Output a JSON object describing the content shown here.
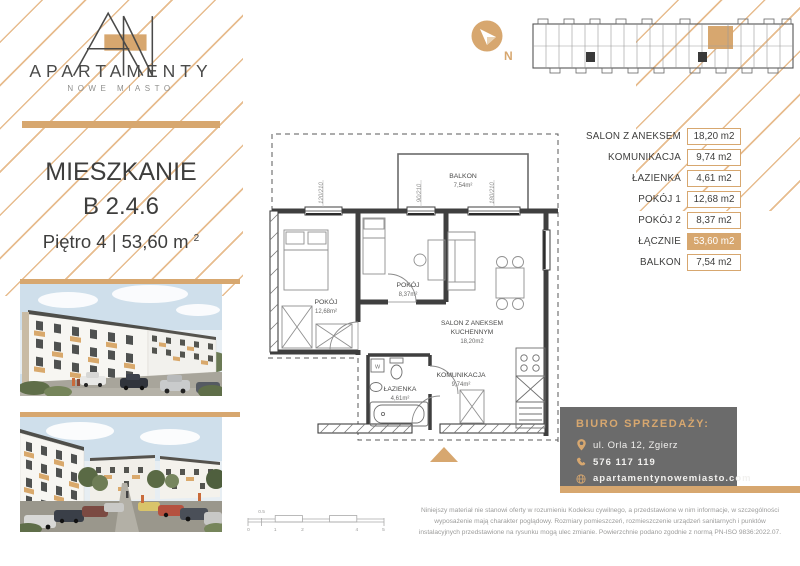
{
  "brand": {
    "name": "APARTAMENTY",
    "subtitle": "NOWE MIASTO",
    "monogram": "AN"
  },
  "compass": {
    "label": "N"
  },
  "listing": {
    "type_label": "MIESZKANIE",
    "unit": "B 2.4.6",
    "floor_line": "Piętro 4 | 53,60 m",
    "area_sup": "2"
  },
  "area_table": {
    "rows": [
      {
        "label": "SALON Z ANEKSEM",
        "value": "18,20 m2"
      },
      {
        "label": "KOMUNIKACJA",
        "value": "9,74 m2"
      },
      {
        "label": "ŁAZIENKA",
        "value": "4,61 m2"
      },
      {
        "label": "POKÓJ 1",
        "value": "12,68 m2"
      },
      {
        "label": "POKÓJ 2",
        "value": "8,37 m2"
      },
      {
        "label": "ŁĄCZNIE",
        "value": "53,60 m2",
        "highlight": true
      },
      {
        "label": "BALKON",
        "value": "7,54 m2"
      }
    ]
  },
  "floor_plan": {
    "balkon": {
      "name": "BALKON",
      "area": "7,54m²"
    },
    "pokoj1": {
      "name": "POKÓJ",
      "area": "12,68m²"
    },
    "pokoj2": {
      "name": "POKÓJ",
      "area": "8,37m²"
    },
    "salon": {
      "line1": "SALON Z ANEKSEM",
      "line2": "KUCHENNYM",
      "area": "18,20m2"
    },
    "komunikacja": {
      "name": "KOMUNIKACJA",
      "area": "9,74m²"
    },
    "lazienka": {
      "name": "ŁAZIENKA",
      "area": "4,61m²"
    },
    "washer_label": "W",
    "window_dims": [
      "120/210",
      "90/210",
      "180/210"
    ]
  },
  "sales_office": {
    "title": "BIURO SPRZEDAŻY:",
    "address": "ul. Orla 12, Zgierz",
    "phone": "576 117 119",
    "website": "apartamentynowemiasto.com"
  },
  "scale_bar": {
    "labels": [
      "0",
      "0.5",
      "1",
      "2",
      "4",
      "5"
    ]
  },
  "disclaimer": {
    "line1": "Niniejszy materiał nie stanowi oferty w rozumieniu Kodeksu cywilnego, a przedstawione w nim informacje, w szczególności",
    "line2": "wyposażenie mają charakter poglądowy. Rozmiary pomieszczeń, rozmieszczenie urządzeń sanitarnych i punktów",
    "line3": "instalacyjnych przedstawione na rysunku mogą ulec zmianie. Powierzchnie podano zgodnie z normą PN-ISO 9836:2022.07."
  },
  "colors": {
    "accent": "#D7A76F",
    "hatch": "#E7BC8E",
    "box_gray": "#6B6B6B",
    "dark_text": "#3E3E3D"
  }
}
